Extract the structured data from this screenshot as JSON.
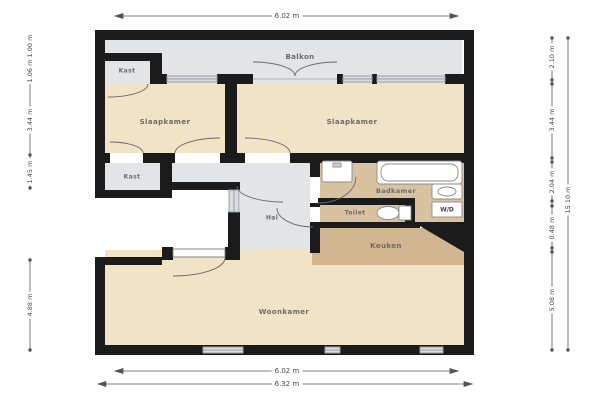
{
  "rooms": {
    "balkon": "Balkon",
    "kast_top": "Kast",
    "slaapkamer_left": "Slaapkamer",
    "slaapkamer_right": "Slaapkamer",
    "kast_mid": "Kast",
    "hal": "Hal",
    "badkamer": "Badkamer",
    "toilet": "Toilet",
    "wd": "W/D",
    "keuken": "Keuken",
    "woonkamer": "Woonkamer"
  },
  "dimensions": {
    "top": "6.02 m",
    "bottom_inner": "6.02 m",
    "bottom_outer": "6.32 m",
    "left": [
      "1.00 m",
      "1.06 m",
      "3.44 m",
      "1.45 m",
      "4.88 m"
    ],
    "right": [
      "2.10 m",
      "3.44 m",
      "2.04 m",
      "0.48 m",
      "5.08 m"
    ],
    "right_total": "15.10 m"
  },
  "colors": {
    "wall": "#1b1b1b",
    "floor_gray": "#e2e4e6",
    "floor_cream": "#f1e3c6",
    "floor_tan": "#d9c2a0",
    "floor_tan_dark": "#d2b690",
    "dim_text": "#4a4a4a"
  }
}
